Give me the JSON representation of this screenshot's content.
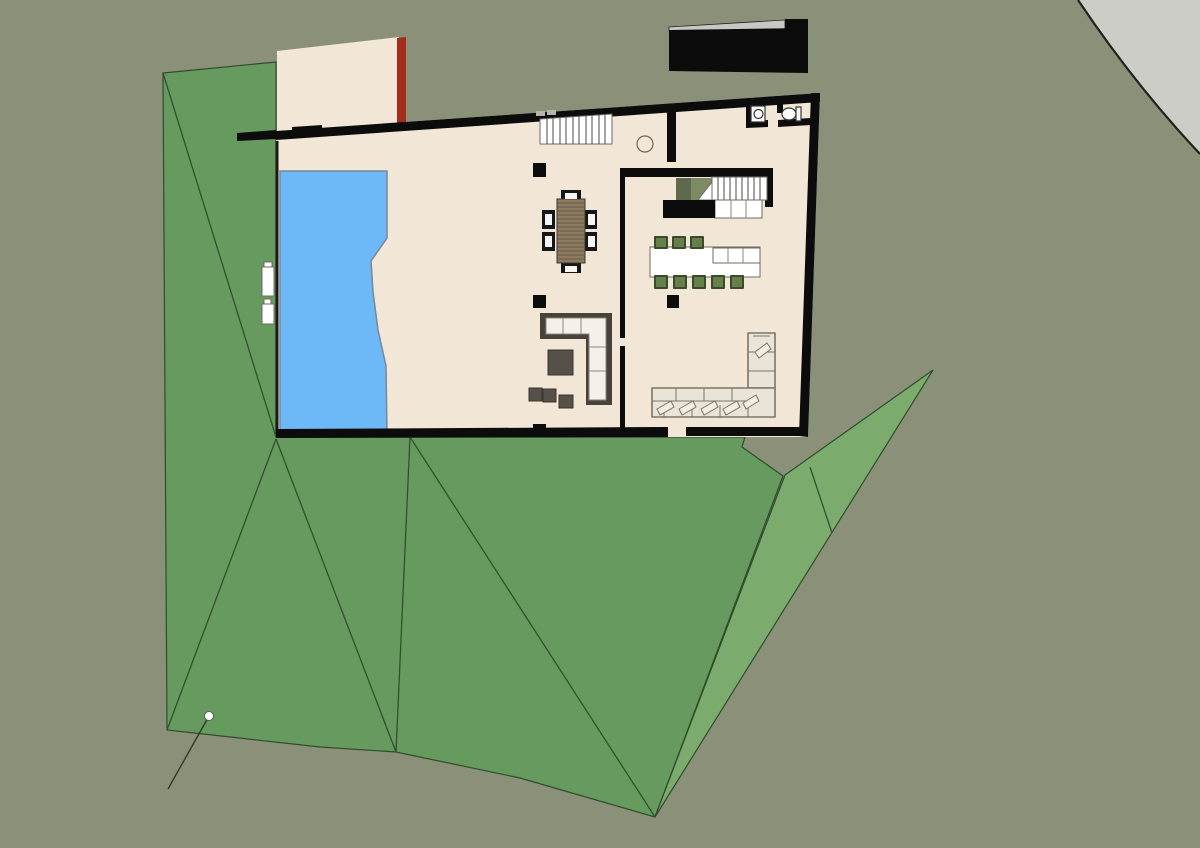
{
  "scene": {
    "width": "1200",
    "height": "848",
    "viewbox": "0 0 1200 848",
    "description": "Top-down architectural floor plan of a house with pool, terraced green lawn and gray site background"
  },
  "colors": {
    "background": "#8b9078",
    "site_corner": "#cbcdc6",
    "terrain_dark": "#679a5e",
    "terrain_light": "#7cab6e",
    "floor_cream": "#f2e7d6",
    "wall_black": "#0c0c0c",
    "accent_red_wall": "#a42c1c",
    "pool_blue": "#6db9f7",
    "stool_green": "#66804b",
    "sofa_dark": "#49423a",
    "sofa_cream": "#eae4d8",
    "table_wood": "#8d7b60"
  },
  "site": {
    "corner_fill_d": "M1078,0 Q1135,85 1200,154 L1200,0 Z",
    "corner_edge_d": "M1078,0 Q1135,85 1200,154",
    "terrain_main_points": "163,73 276,62 276,437 745,437 742,447 783,476 655,817 520,778 396,752 320,747 167,730",
    "terrain_folds_d": "M163,73 L276,437 M276,439 L167,730 M276,439 L396,752 M410,437 L396,752 M410,437 L655,817",
    "terrain_wedge_points": "933,370 785,475 655,817",
    "wedge_fold_d": "M810,467 L832,533",
    "leader_line_d": "M209,716 L168,789",
    "survey_dot_d": "M204.5,716 a4.5,4.5 0 1 0 9,0 a4.5,4.5 0 1 0 -9,0"
  },
  "roof_block": {
    "gray_band_points": "669,27 785,20 785,29 669,31",
    "black_cap_points": "785,19 808,19 808,29 785,29",
    "black_body_points": "669,30 808,28 808,73 669,71"
  },
  "house": {
    "floor_points": "276,131 820,93 808,437 276,437",
    "patio_points": "277,51 399,37 399,131 277,131",
    "red_wall_points": "397,38 406,37 406,123 397,124",
    "outer_walls_d": "M276,131 L820,93 L820,102 L276,140 Z M237,133 L276,130 L276,139 L237,141 Z M292,127 L322,125 L322,134 L292,136 Z M811,93 L820,93 L808,437 L799,436 Z M276,429 L668,427 L668,437 L276,438 Z M686,427 L808,427 L808,436 L686,436 Z",
    "interior_walls_d": "M667,112 L676,111 L676,162 L667,162 Z M620,168 L773,168 L773,177 L620,177 Z M765,177 L773,177 L773,207 L765,207 Z M620,177 L625,177 L625,338 L620,338 Z M620,346 L625,346 L625,429 L620,429 Z",
    "bathroom_walls_d": "M746,99 L753,98 L753,127 L746,128 Z M746,121 L768,120 L768,127 L746,128 Z M778,120 L811,118 L811,125 L778,127 Z M777,97 L783,97 L783,113 L777,113 Z",
    "deck_edge_d": "M277,141 L277,434",
    "window_marks_d": "M536,111 h9 v5 h-9 z M547,110 h9 v5 h-9 z",
    "columns_d": "M533,163 h13 v14 h-13 z M533,295 h13 v13 h-13 z M533,424 h13 v13 h-13 z M667,295 h12 v13 h-12 z",
    "hall_circle_d": "M637,144 a8,8 0 1 0 16,0 a8,8 0 1 0 -16,0"
  },
  "pool": {
    "points": "280,171 387,171 387,238 371,261 373,292 378,330 386,366 387,432 280,432",
    "lounger1_points": "262,267 274,267 274,296 262,296",
    "lounger1_head_points": "264,262 272,262 272,267 264,267",
    "lounger2_points": "262,304 274,304 274,324 262,324",
    "lounger2_head_points": "264,299 271,299 271,304 264,304"
  },
  "stairs": {
    "stair1_points": "540,119 612,114 612,144 540,144",
    "stair1_treads_d": "M547,118.5 V144 M553,118.1 V144 M560,117.6 V144 M566,117.2 V144 M573,116.7 V144 M579,116.3 V144 M586,115.8 V144 M592,115.4 V144 M599,114.9 V144 M605,114.5 V144",
    "stair2_points": "712,177 767,177 767,200 712,200",
    "stair2_treads_d": "M718,177 V200 M724,177 V200 M730,177 V200 M736,177 V200 M742,177 V200 M748,177 V200 M754,177 V200 M760,177 V200",
    "landing_points": "715,200 762,200 762,218 715,218",
    "landing_lines_d": "M731,200 V218 M746,200 V218",
    "void_dark_points": "676,178 691,178 691,200 676,200",
    "void_light_points": "691,178 712,178 712,200 691,200",
    "void_triangle_points": "712,182 712,200 698,200"
  },
  "kitchen": {
    "counter_black_points": "663,200 715,200 715,218 663,218",
    "island_points": "650,247 760,247 760,277 650,277",
    "island_cells_points": "713,248 760,248 760,263 713,263",
    "island_cell_lines_d": "M728,248 V263 M743,248 V263",
    "stools_d": "M655,237 h12 v11 h-12 z M673,237 h12 v11 h-12 z M691,237 h12 v11 h-12 z M655,276 h12 v12 h-12 z M674,276 h12 v12 h-12 z M693,276 h12 v12 h-12 z M712,276 h12 v12 h-12 z M731,276 h12 v12 h-12 z"
  },
  "dining": {
    "table_points": "557,199 585,199 585,263 557,263",
    "slats_d": "M557,203 H585 M557,207 H585 M557,211 H585 M557,215 H585 M557,219 H585 M557,223 H585 M557,227 H585 M557,231 H585 M557,235 H585 M557,239 H585 M557,243 H585 M557,247 H585 M557,251 H585 M557,255 H585 M557,259 H585",
    "chairs_d": "M561,190 h20 v12 h-20 z M561,261 h20 v12 h-20 z M542,210 h13 v19 h-13 z M542,232 h13 v19 h-13 z M584,210 h13 v19 h-13 z M584,232 h13 v19 h-13 z",
    "chair_pads_d": "M565,193 h12 v6 h-12 z M565,266 h12 v6 h-12 z M545,214 h7 v11 h-7 z M545,236 h7 v11 h-7 z M588,214 h7 v11 h-7 z M588,236 h7 v11 h-7 z"
  },
  "lounge": {
    "lsofa_frame_points": "540,313 612,313 612,405 586,405 586,339 540,339",
    "lsofa_cushions_points": "546,318 606,318 606,400 589,400 589,334 546,334",
    "lsofa_lines_d": "M563,318 V334 M581,318 V334 M589,347 H606 M589,371 H606",
    "coffee_table_points": "548,350 573,350 573,375 548,375",
    "poufs_d": "M529,388 h13 v13 h-13 z M543,389 h13 v13 h-13 z M559,395 h14 v13 h-14 z"
  },
  "family_room": {
    "sectional_arm_points": "748,333 775,333 775,388 748,388",
    "sectional_seat_points": "652,388 775,388 775,417 652,417",
    "sectional_lines_d": "M652,401 H748 M676,388 V401 M704,388 V401 M732,388 V401 M664,405 V417 M692,405 V417 M720,405 V417 M748,405 V417 M748,352 H775 M748,371 H775 M753,336 H770",
    "pillows_d": "M657,409 L671,401 L674,407 L660,415 Z M679,409 L693,401 L696,407 L682,415 Z M701,409 L715,401 L718,407 L704,415 Z M723,409 L737,401 L740,407 L726,415 Z M743,403 L756,395 L759,401 L746,409 Z M755,352 L767,343 L771,349 L759,358 Z"
  },
  "bathroom": {
    "sink_d": "M751,106 h14 v16 h-14 z",
    "sink_bowl_d": "M754,114 a4.5,4.5 0 1 0 9,0 a4.5,4.5 0 1 0 -9,0",
    "toilet_d": "M782,114 a7,6 0 1 0 14,0 a7,6 0 1 0 -14,0 M796,107 h5 v14 h-5 z"
  }
}
